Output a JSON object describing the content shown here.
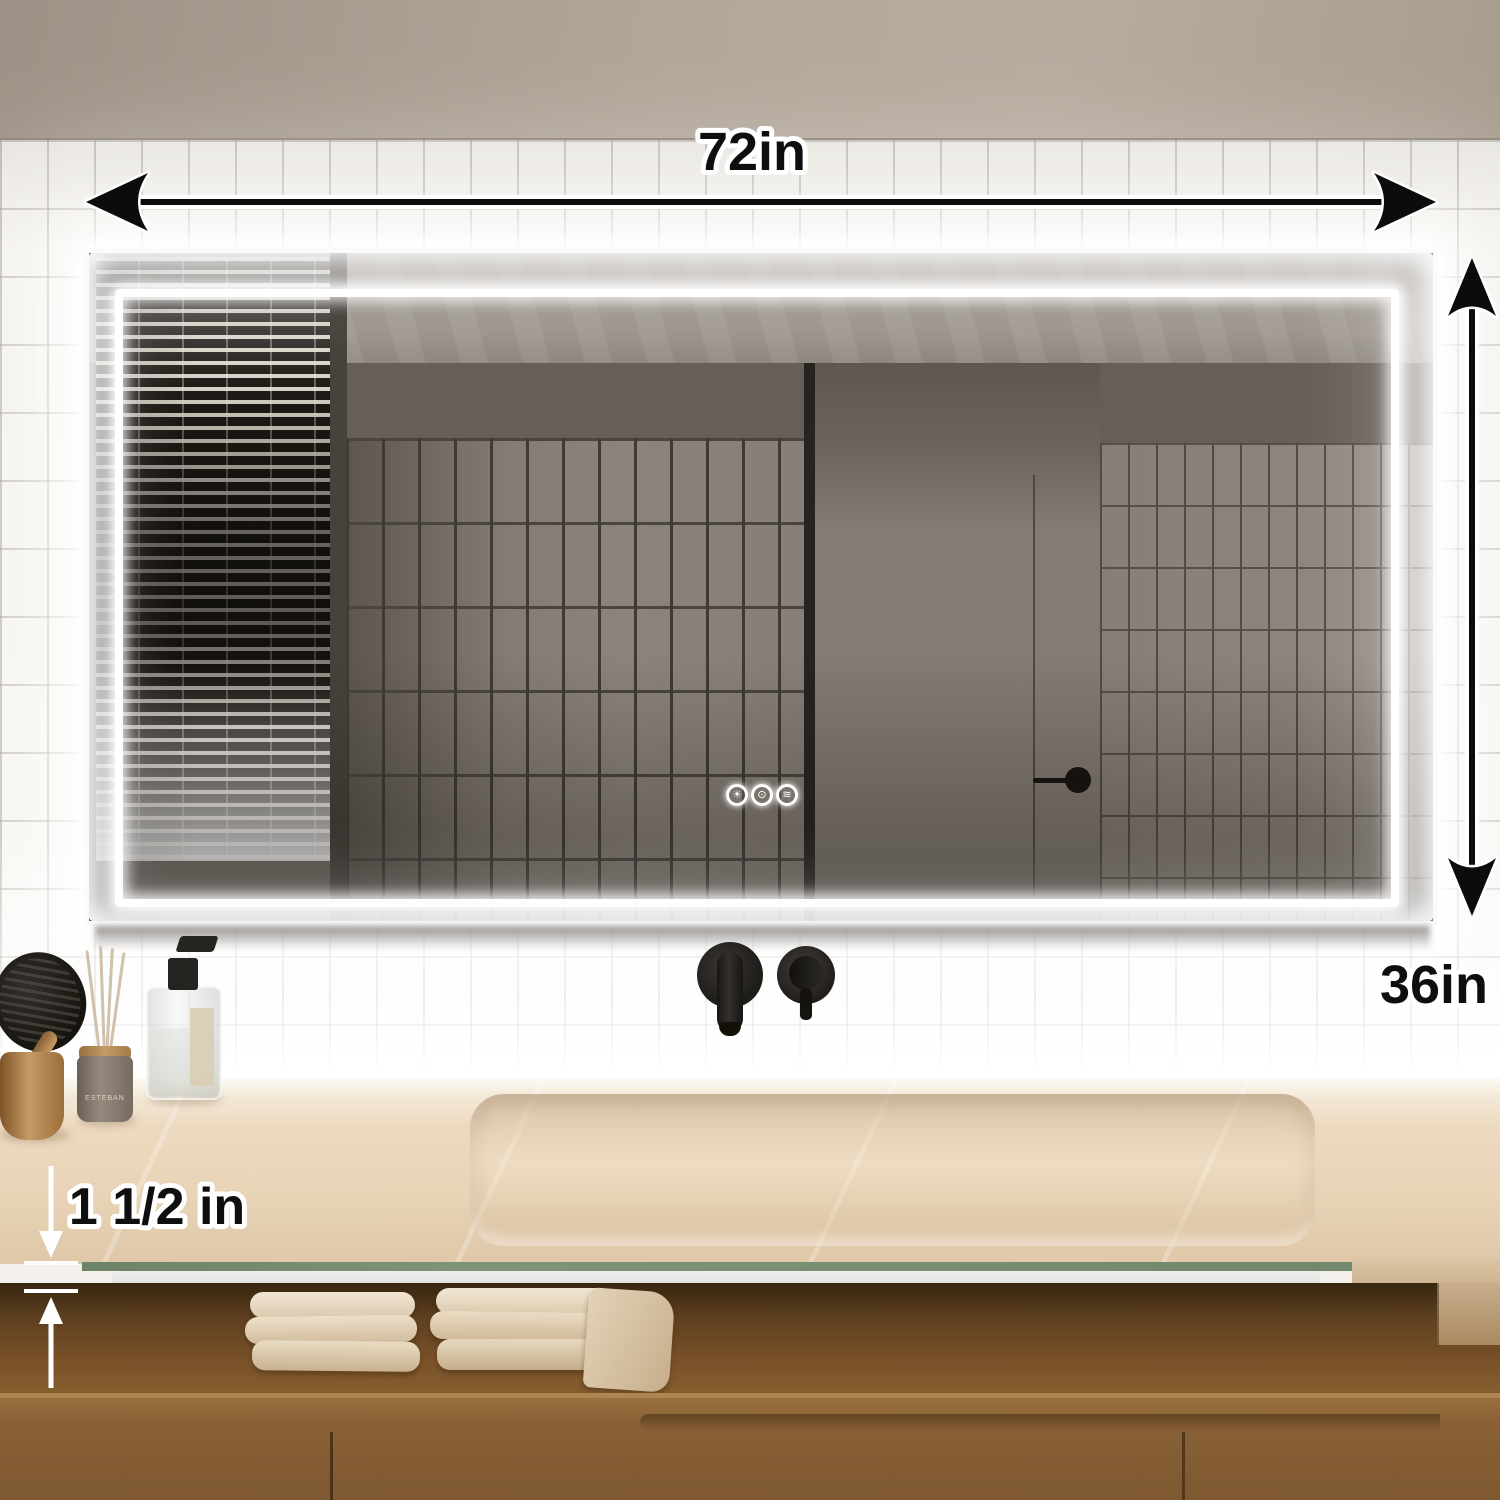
{
  "meta": {
    "description": "Product photo of a 72 x 36 inch LED backlit bathroom vanity mirror with dimension annotations"
  },
  "annotations": {
    "width_label": "72in",
    "height_label": "36in",
    "thickness_label": "1 1/2 in"
  },
  "mirror": {
    "touch_buttons": [
      {
        "name": "brightness-button",
        "icon": "sun-icon",
        "glyph": "☀"
      },
      {
        "name": "color-temp-button",
        "icon": "bulb-icon",
        "glyph": "⊙"
      },
      {
        "name": "defog-button",
        "icon": "defog-icon",
        "glyph": "≋"
      }
    ]
  },
  "props": {
    "diffuser_label": "ESTEBAN"
  },
  "colors": {
    "annotation_text": "#0e0e0e",
    "annotation_outline": "#ffffff",
    "led_glow": "#ffffff",
    "glass_edge_green": "#7a9172",
    "counter_beige": "#e8d3b6",
    "wood_brown": "#855c32"
  }
}
